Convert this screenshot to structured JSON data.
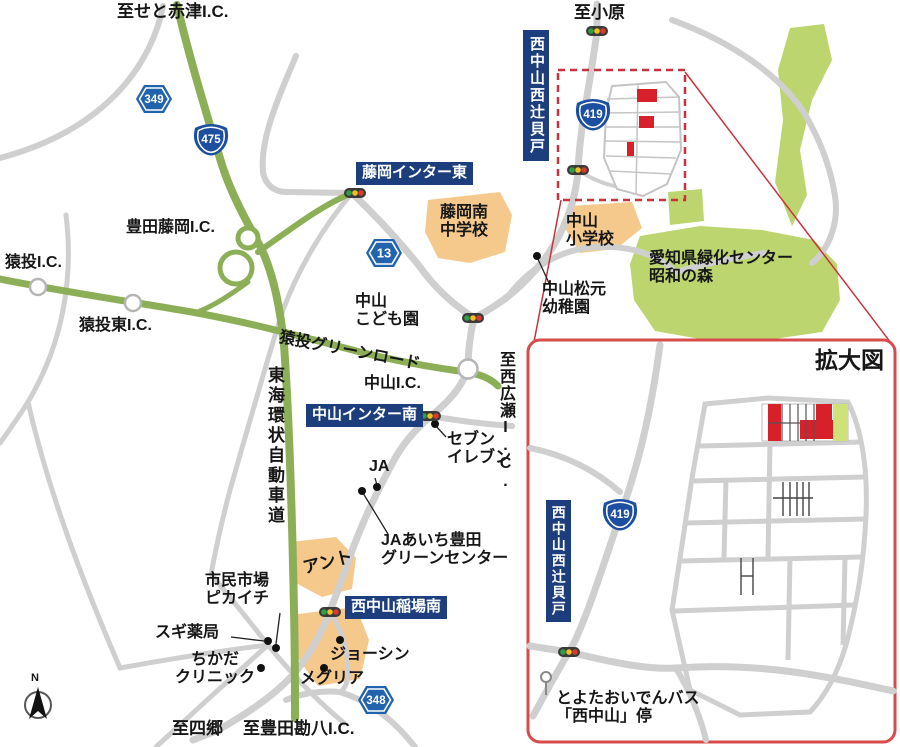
{
  "labels": {
    "seto_akatsu": "至せと赤津I.C.",
    "obara": "至小原",
    "toyota_fujioka_ic": "豊田藤岡I.C.",
    "sanage_ic": "猿投I.C.",
    "sanage_higashi_ic": "猿投東I.C.",
    "fujioka_minami": "藤岡南\n中学校",
    "nakayama_sho": "中山\n小学校",
    "nakayama_matsumoto": "中山松元\n幼稚園",
    "ryokka_center": "愛知県緑化センター\n昭和の森",
    "nakayama_kodomoen": "中山\nこども園",
    "sanage_greenroad": "猿投グリーンロード",
    "nakayama_ic": "中山I.C.",
    "nishi_hirose": "至西広瀬I.C.",
    "seven_eleven": "セブン\nイレブン",
    "ja": "JA",
    "ja_green_center": "JAあいち豊田\nグリーンセンター",
    "tokai_kanjo": "東海環状自動車道",
    "ant": "アント",
    "shimin_ichiba": "市民市場\nピカイチ",
    "sugi": "スギ薬局",
    "chikada": "ちかだ\nクリニック",
    "joshin": "ジョーシン",
    "megria": "メグリア",
    "shigo": "至四郷",
    "kampachi": "至豊田勘八I.C.",
    "north": "N"
  },
  "signs": {
    "fujioka_inter_east": "藤岡インター東",
    "nakayama_inter_minami": "中山インター南",
    "inaba_minami": "西中山稲場南",
    "nishi_tsujikaido": "西中山西辻貝戸"
  },
  "routes": {
    "r349": "349",
    "r475": "475",
    "r13": "13",
    "r419": "419",
    "r348": "348"
  },
  "inset": {
    "title": "拡大図",
    "box": "西中山西辻貝戸",
    "r419": "419",
    "bus": "とよたおいでんバス\n「西中山」停"
  },
  "colors": {
    "sign_navy": "#1c3e7c",
    "road_green": "#8cae57",
    "area_green": "#bdd56f",
    "area_orange": "#f5c98c",
    "road_gray": "#cfcfcf",
    "site_red": "#d8202a",
    "dashed_box_red": "#c8323c",
    "inset_border_red": "#d94b4b",
    "shield_blue": "#2263ae",
    "onigiri_blue": "#1d4fa1"
  }
}
